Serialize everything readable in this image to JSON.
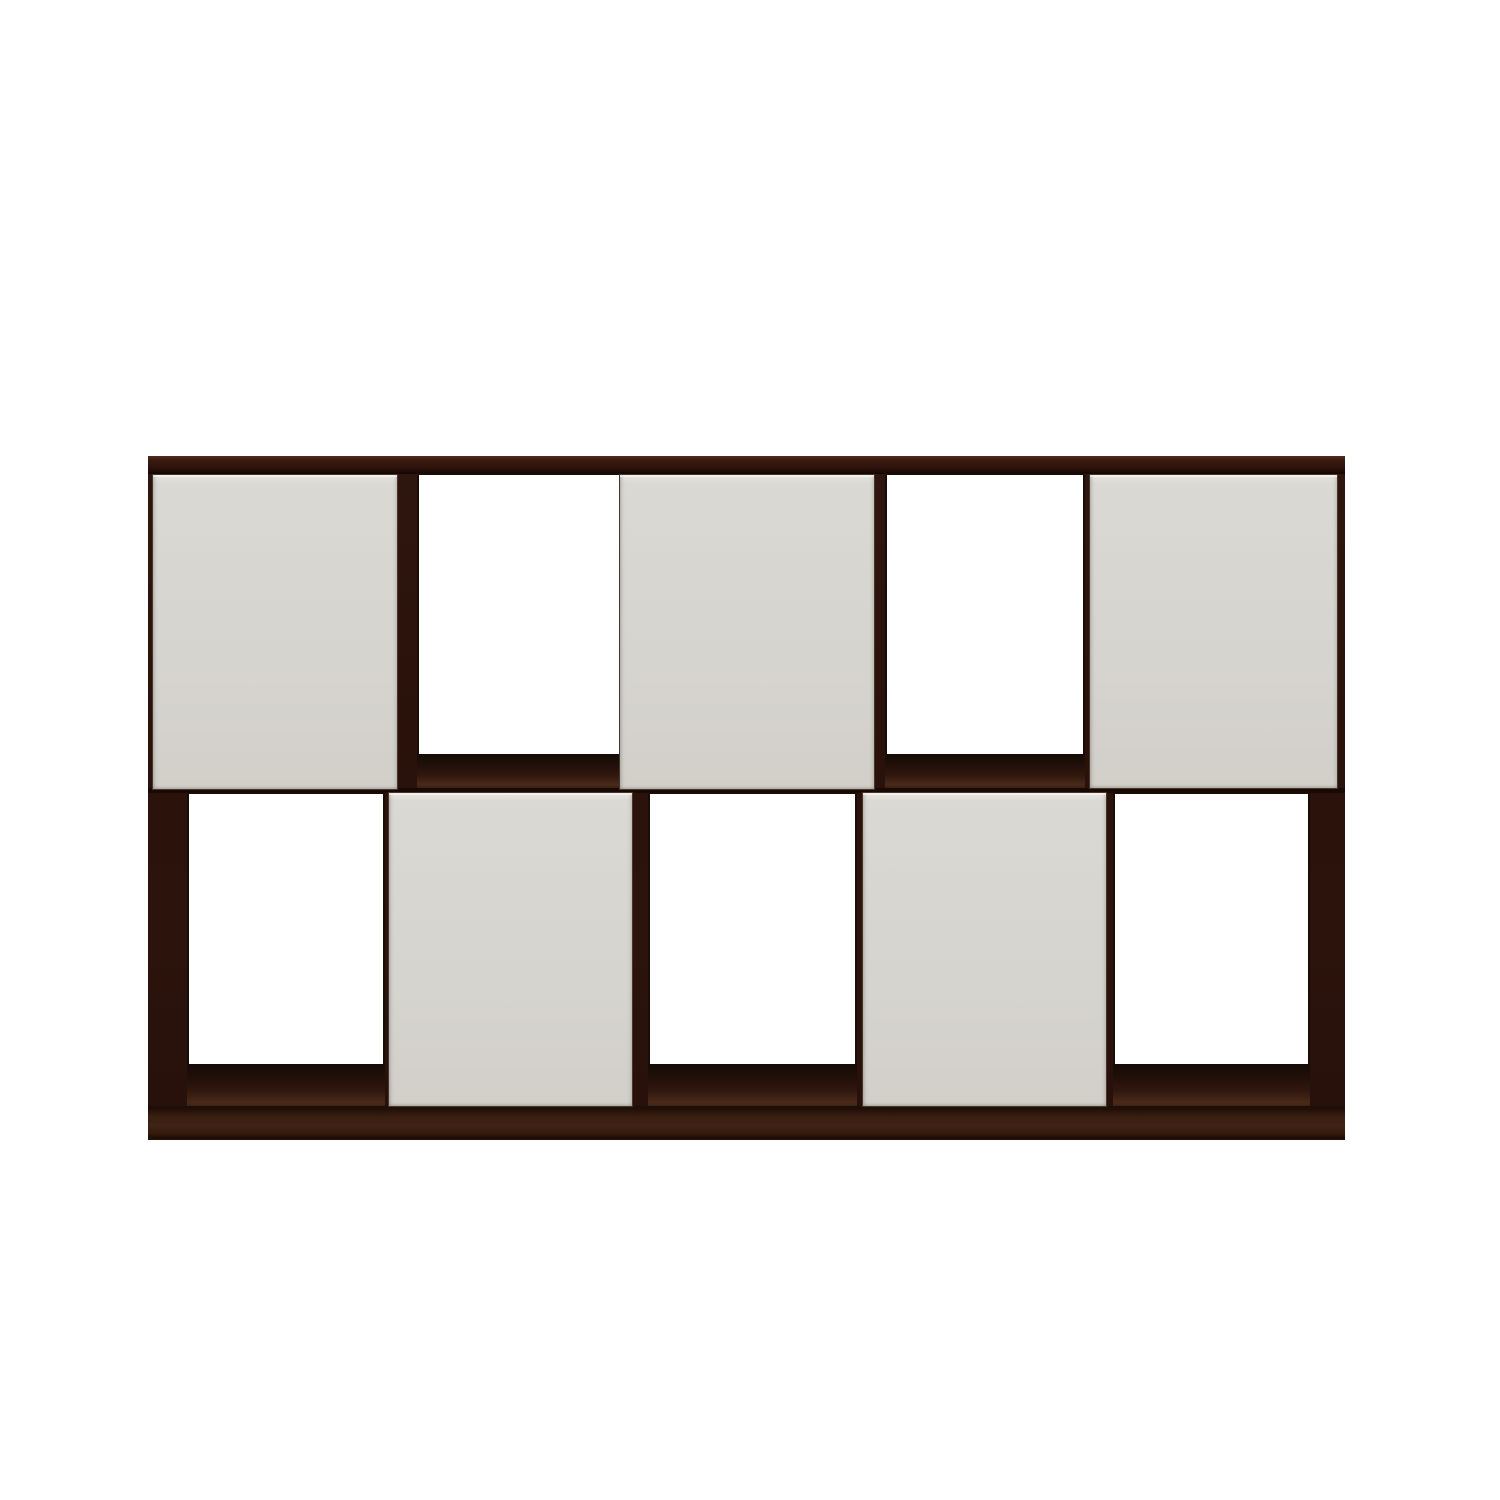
{
  "scene": {
    "description": "Straight-on product photo of a low, wide cube-storage shelving unit on a plain white background. Dark espresso wood frame with two rows of five compartments; five off-white overlay doors arranged in a checkerboard pattern (top row columns 1,3,5; bottom row columns 2,4); the remaining five compartments are open cubbies.",
    "object": "cube-storage-shelving-unit",
    "rows": 2,
    "columns": 5,
    "compartments": 10,
    "doors_count": 5,
    "open_cubbies_count": 5,
    "door_pattern": "checkerboard",
    "background_color": "#ffffff",
    "colors": {
      "frame_espresso": "#2c130c",
      "frame_edge_highlight": "#542c1e",
      "frame_inner_line": "#170a05",
      "floor_wood_light": "#4a2a19",
      "door_offwhite": "#d7d5cf",
      "door_outline": "#4a3528",
      "cubby_interior": "#ffffff"
    },
    "unit_bounds_px": {
      "x": 148,
      "y": 456,
      "w": 1197,
      "h": 684
    },
    "rects": [
      {
        "name": "carcass-frame",
        "cls": "frame",
        "x": 148,
        "y": 456,
        "w": 1197,
        "h": 684
      },
      {
        "name": "top-panel-edge",
        "cls": "top-edge",
        "x": 148,
        "y": 456,
        "w": 1197,
        "h": 18
      },
      {
        "name": "open-cubby-top-2",
        "cls": "opening",
        "x": 417,
        "y": 473,
        "w": 204,
        "h": 283
      },
      {
        "name": "open-cubby-top-4",
        "cls": "opening",
        "x": 885,
        "y": 473,
        "w": 200,
        "h": 283
      },
      {
        "name": "open-cubby-bottom-1",
        "cls": "opening",
        "x": 187,
        "y": 792,
        "w": 198,
        "h": 274
      },
      {
        "name": "open-cubby-bottom-3",
        "cls": "opening",
        "x": 648,
        "y": 792,
        "w": 209,
        "h": 274
      },
      {
        "name": "open-cubby-bottom-5",
        "cls": "opening",
        "x": 1113,
        "y": 792,
        "w": 197,
        "h": 274
      },
      {
        "name": "cubby-floor-top-2",
        "cls": "floor",
        "x": 417,
        "y": 754,
        "w": 204,
        "h": 35
      },
      {
        "name": "cubby-floor-top-4",
        "cls": "floor",
        "x": 885,
        "y": 754,
        "w": 200,
        "h": 35
      },
      {
        "name": "cubby-floor-bottom-1",
        "cls": "floor",
        "x": 187,
        "y": 1064,
        "w": 198,
        "h": 44
      },
      {
        "name": "cubby-floor-bottom-3",
        "cls": "floor",
        "x": 648,
        "y": 1064,
        "w": 209,
        "h": 44
      },
      {
        "name": "cubby-floor-bottom-5",
        "cls": "floor",
        "x": 1113,
        "y": 1064,
        "w": 197,
        "h": 44
      },
      {
        "name": "middle-shelf-edge",
        "cls": "shelf-line",
        "x": 148,
        "y": 788,
        "w": 1197,
        "h": 5
      },
      {
        "name": "bottom-panel-edge",
        "cls": "bottom-rail",
        "x": 148,
        "y": 1106,
        "w": 1197,
        "h": 34
      },
      {
        "name": "door-top-1",
        "cls": "door",
        "x": 152,
        "y": 474,
        "w": 246,
        "h": 316
      },
      {
        "name": "door-top-3",
        "cls": "door",
        "x": 619,
        "y": 474,
        "w": 256,
        "h": 316
      },
      {
        "name": "door-top-5",
        "cls": "door",
        "x": 1089,
        "y": 474,
        "w": 249,
        "h": 315
      },
      {
        "name": "door-bottom-2",
        "cls": "door",
        "x": 388,
        "y": 792,
        "w": 245,
        "h": 315
      },
      {
        "name": "door-bottom-4",
        "cls": "door",
        "x": 862,
        "y": 792,
        "w": 245,
        "h": 315
      }
    ]
  }
}
